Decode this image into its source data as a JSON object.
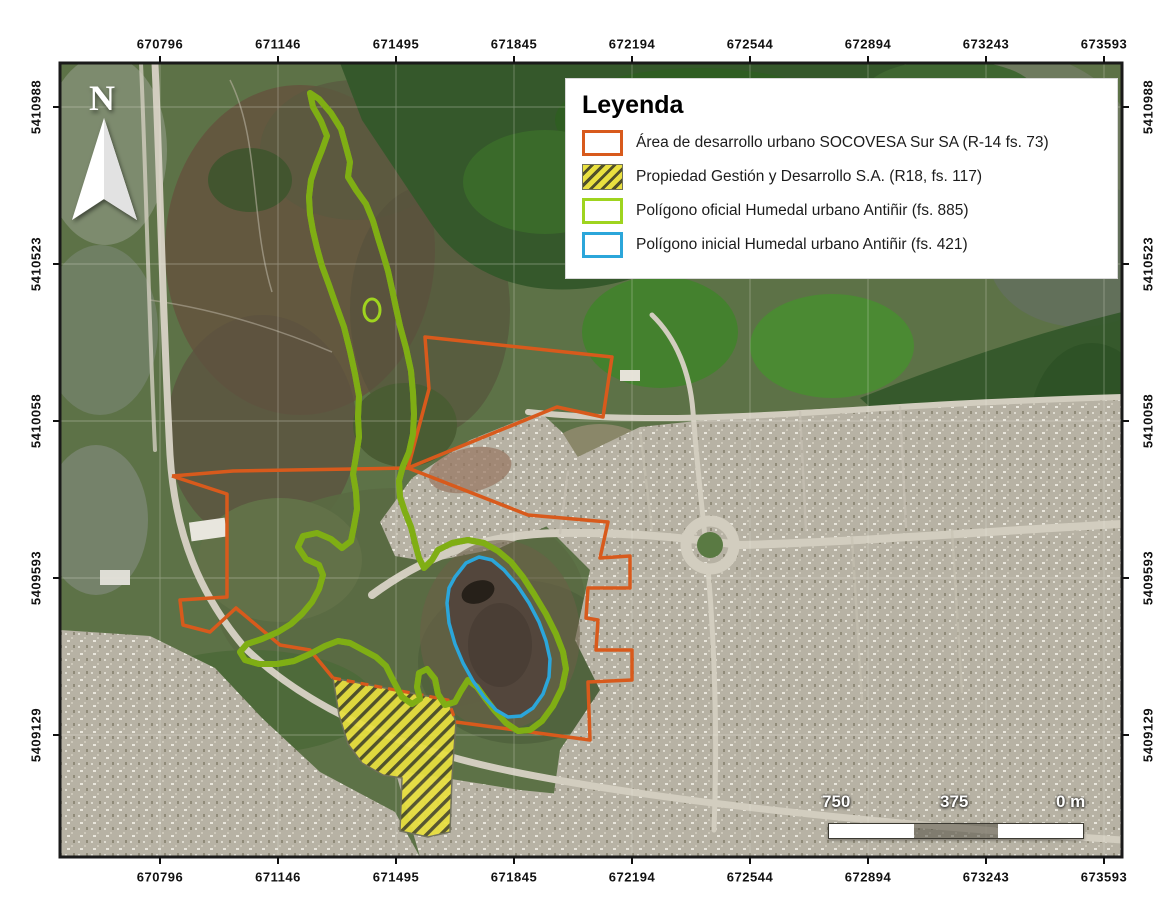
{
  "map": {
    "axis": {
      "x_labels": [
        "670796",
        "671146",
        "671495",
        "671845",
        "672194",
        "672544",
        "672894",
        "673243",
        "673593"
      ],
      "y_labels": [
        "5410988",
        "5410523",
        "5410058",
        "5409593",
        "5409129"
      ]
    },
    "legend": {
      "title": "Leyenda",
      "items": [
        {
          "label": "Área de desarrollo urbano SOCOVESA Sur SA  (R-14 fs. 73)",
          "swatch": "orange-outline"
        },
        {
          "label": "Propiedad Gestión y Desarrollo S.A. (R18, fs. 117)",
          "swatch": "yellow-hatch"
        },
        {
          "label": "Polígono oficial Humedal urbano Antiñir (fs. 885)",
          "swatch": "green-outline"
        },
        {
          "label": "Polígono inicial Humedal urbano Antiñir (fs. 421)",
          "swatch": "blue-outline"
        }
      ]
    },
    "scalebar": {
      "labels": [
        "750",
        "375",
        "0 m"
      ]
    },
    "north_arrow": {
      "label": "N"
    },
    "colors": {
      "orange": "#d85a1c",
      "green": "#9fd41f",
      "green_dark": "#7fae14",
      "blue": "#2ba6da",
      "hatch_fill": "#e9e03f",
      "hatch_line": "#50502a",
      "hatch_border": "#70705a",
      "frame": "#1a1a1a",
      "urban": "#b7b2a4",
      "road": "#d2cdbf",
      "forest": "#35582b",
      "scrub": "#64563f",
      "field": "#44812e",
      "lagoon": "#53463c"
    }
  }
}
